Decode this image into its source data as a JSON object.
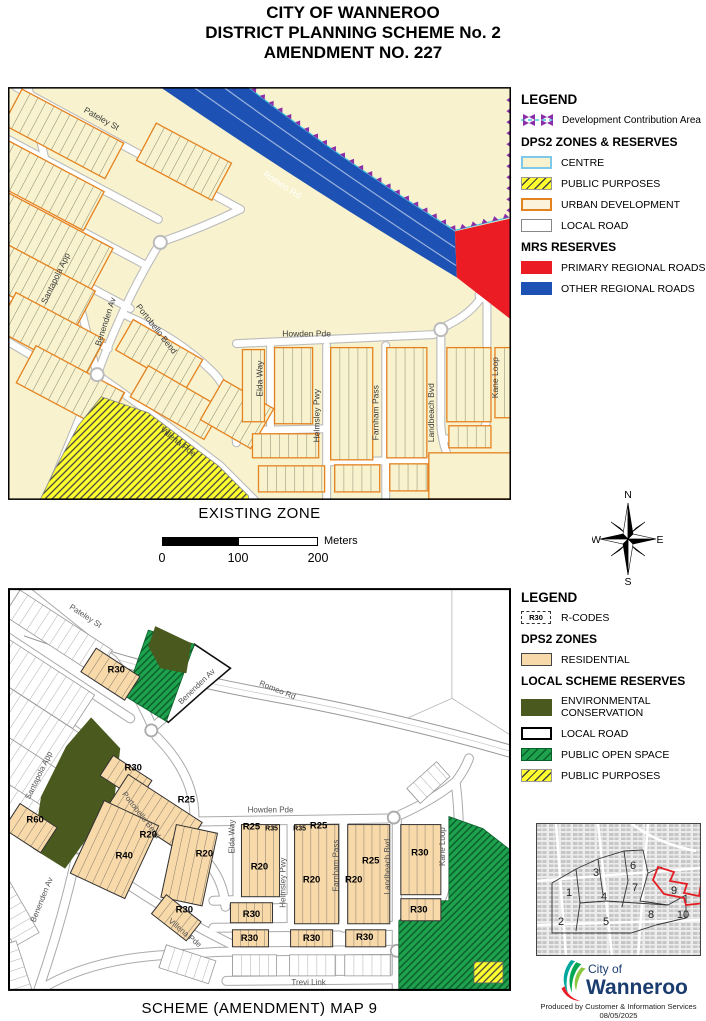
{
  "title": {
    "line1": "CITY OF WANNEROO",
    "line2": "DISTRICT PLANNING SCHEME No. 2",
    "line3": "AMENDMENT NO. 227"
  },
  "captions": {
    "existing": "EXISTING ZONE",
    "scheme": "SCHEME (AMENDMENT) MAP 9"
  },
  "scalebar": {
    "ticks": [
      "0",
      "100",
      "200"
    ],
    "unit": "Meters"
  },
  "compass": {
    "n": "N",
    "e": "E",
    "s": "S",
    "w": "W"
  },
  "legend_top": {
    "heading": "LEGEND",
    "dca_label": "Development Contribution Area",
    "zones_heading": "DPS2 ZONES & RESERVES",
    "centre": "CENTRE",
    "public_purposes": "PUBLIC PURPOSES",
    "urban_development": "URBAN DEVELOPMENT",
    "local_road": "LOCAL ROAD",
    "mrs_heading": "MRS RESERVES",
    "primary_regional_roads": "PRIMARY REGIONAL ROADS",
    "other_regional_roads": "OTHER REGIONAL ROADS"
  },
  "legend_bottom": {
    "heading": "LEGEND",
    "rcode_box": "R30",
    "rcode_label": "R-CODES",
    "zones_heading": "DPS2 ZONES",
    "residential": "RESIDENTIAL",
    "reserves_heading": "LOCAL SCHEME RESERVES",
    "env1": "ENVIRONMENTAL",
    "env2": "CONSERVATION",
    "local_road": "LOCAL ROAD",
    "public_open_space": "PUBLIC OPEN SPACE",
    "public_purposes": "PUBLIC PURPOSES"
  },
  "maps": {
    "existing": {
      "street_labels": [
        {
          "t": "Pateley St",
          "x": 92,
          "y": 34,
          "r": 29
        },
        {
          "t": "Romeo Rd",
          "x": 272,
          "y": 100,
          "r": 33,
          "c": "#FFFFFF",
          "s": 9
        },
        {
          "t": "Santapola App",
          "x": 50,
          "y": 192,
          "r": -64
        },
        {
          "t": "Benenden Av",
          "x": 100,
          "y": 235,
          "r": -72
        },
        {
          "t": "Portobello Bend",
          "x": 146,
          "y": 243,
          "r": 52
        },
        {
          "t": "Howden Pde",
          "x": 298,
          "y": 249,
          "r": 0
        },
        {
          "t": "Elda Way",
          "x": 254,
          "y": 291,
          "r": -90
        },
        {
          "t": "Helmsley Pwy",
          "x": 311,
          "y": 328,
          "r": -90
        },
        {
          "t": "Farnham Pass",
          "x": 370,
          "y": 325,
          "r": -90
        },
        {
          "t": "Landbeach Bvd",
          "x": 425,
          "y": 325,
          "r": -90
        },
        {
          "t": "Kane Loop",
          "x": 489,
          "y": 290,
          "r": -90
        },
        {
          "t": "Villena Pde",
          "x": 168,
          "y": 356,
          "r": 38
        }
      ]
    },
    "scheme": {
      "street_labels": [
        {
          "t": "Pateley St",
          "x": 76,
          "y": 30,
          "r": 33
        },
        {
          "t": "Romeo Rd",
          "x": 268,
          "y": 104,
          "r": 22
        },
        {
          "t": "Benenden Av",
          "x": 190,
          "y": 100,
          "r": -44
        },
        {
          "t": "Santapola App",
          "x": 33,
          "y": 188,
          "r": -64
        },
        {
          "t": "Portobello Bend",
          "x": 131,
          "y": 228,
          "r": 52
        },
        {
          "t": "Howden Pde",
          "x": 262,
          "y": 224,
          "r": 0
        },
        {
          "t": "Elda Way",
          "x": 226,
          "y": 248,
          "r": -90
        },
        {
          "t": "Helmsley Pwy",
          "x": 277,
          "y": 294,
          "r": -90
        },
        {
          "t": "Farnham Pass",
          "x": 330,
          "y": 277,
          "r": -90
        },
        {
          "t": "Landbeach Bvd",
          "x": 381,
          "y": 278,
          "r": -90
        },
        {
          "t": "Kane Loop",
          "x": 436,
          "y": 258,
          "r": -90
        },
        {
          "t": "Villena Pde",
          "x": 175,
          "y": 346,
          "r": 40
        },
        {
          "t": "Benenden Av",
          "x": 36,
          "y": 312,
          "r": -68
        },
        {
          "t": "Trevi Link",
          "x": 300,
          "y": 396,
          "r": 0
        }
      ],
      "rcode_labels": [
        {
          "t": "R30",
          "x": 108,
          "y": 84
        },
        {
          "t": "R30",
          "x": 125,
          "y": 182
        },
        {
          "t": "R25",
          "x": 178,
          "y": 214
        },
        {
          "t": "R20",
          "x": 140,
          "y": 249
        },
        {
          "t": "R40",
          "x": 116,
          "y": 270
        },
        {
          "t": "R60",
          "x": 27,
          "y": 234
        },
        {
          "t": "R20",
          "x": 196,
          "y": 268
        },
        {
          "t": "R30",
          "x": 176,
          "y": 324
        },
        {
          "t": "R25",
          "x": 243,
          "y": 241
        },
        {
          "t": "R35",
          "x": 263,
          "y": 242,
          "s": 7
        },
        {
          "t": "R35",
          "x": 291,
          "y": 242,
          "s": 7
        },
        {
          "t": "R25",
          "x": 310,
          "y": 240
        },
        {
          "t": "R20",
          "x": 251,
          "y": 281
        },
        {
          "t": "R20",
          "x": 303,
          "y": 294
        },
        {
          "t": "R25",
          "x": 362,
          "y": 275
        },
        {
          "t": "R20",
          "x": 345,
          "y": 294
        },
        {
          "t": "R30",
          "x": 411,
          "y": 267
        },
        {
          "t": "R30",
          "x": 410,
          "y": 324
        },
        {
          "t": "R30",
          "x": 243,
          "y": 328
        },
        {
          "t": "R30",
          "x": 241,
          "y": 352
        },
        {
          "t": "R30",
          "x": 303,
          "y": 352
        },
        {
          "t": "R30",
          "x": 356,
          "y": 351
        }
      ]
    }
  },
  "inset": {
    "labels": [
      {
        "t": "1",
        "x": 33,
        "y": 73
      },
      {
        "t": "2",
        "x": 25,
        "y": 102
      },
      {
        "t": "3",
        "x": 60,
        "y": 53
      },
      {
        "t": "4",
        "x": 68,
        "y": 77
      },
      {
        "t": "5",
        "x": 70,
        "y": 102
      },
      {
        "t": "6",
        "x": 97,
        "y": 46
      },
      {
        "t": "7",
        "x": 99,
        "y": 68
      },
      {
        "t": "8",
        "x": 115,
        "y": 95
      },
      {
        "t": "9",
        "x": 138,
        "y": 71
      },
      {
        "t": "10",
        "x": 147,
        "y": 95
      }
    ]
  },
  "logo": {
    "line1": "City of",
    "line2": "Wanneroo"
  },
  "credits": {
    "line1": "Produced by Customer & Information Services",
    "line2": "08/05/2025"
  },
  "colors": {
    "cream": "#F8F3CE",
    "orange": "#E58220",
    "regional_blue": "#1D52B4",
    "regional_red": "#EC1C24",
    "dca_purple": "#8B2FA8",
    "dca_cyan": "#45C6E0",
    "public_purposes_yellow": "#FFFF2E",
    "residential_peach": "#F8D9A9",
    "environmental_olive": "#4A5A1E",
    "open_space_green": "#1FA24E",
    "logo_navy": "#1A3C6E"
  }
}
